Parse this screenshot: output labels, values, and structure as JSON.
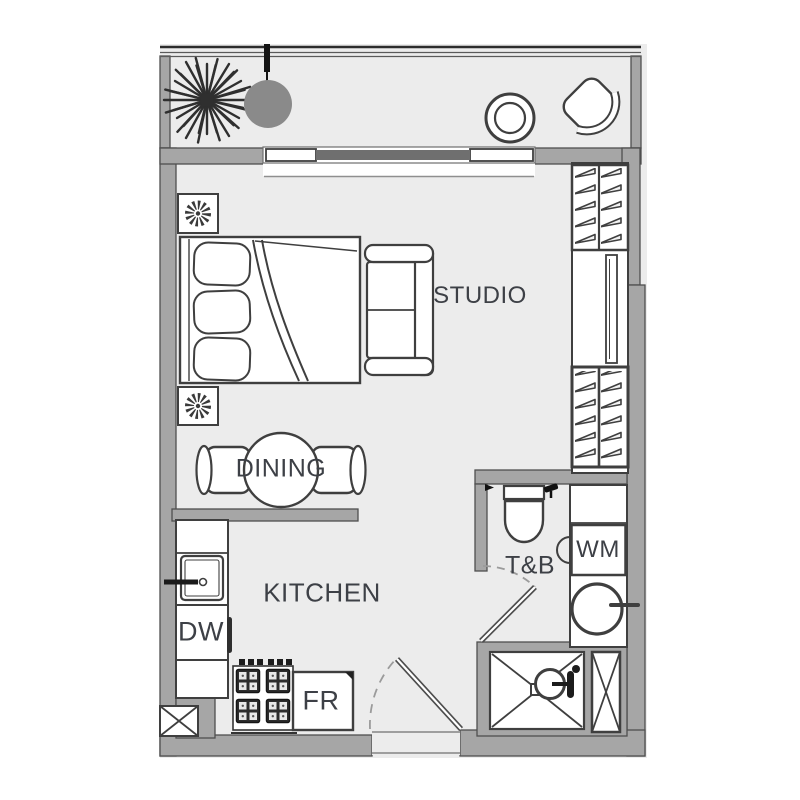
{
  "title": "Studio unit floor plan",
  "labels": {
    "studio": "STUDIO",
    "dining": "DINING",
    "kitchen": "KITCHEN",
    "bath": "T&B",
    "washing_machine": "WM",
    "dishwasher": "DW",
    "fridge": "FR"
  },
  "icons": [
    "plant-icon",
    "pendant-ball-icon",
    "round-table-icon",
    "armchair-icon",
    "ceiling-fan-icon",
    "bed-icon",
    "pillow-icon",
    "sofa-icon",
    "dining-table-icon",
    "dining-chair-icon",
    "hanger-rack-icon",
    "mirror-panel-icon",
    "toilet-icon",
    "tap-icon",
    "shower-head-icon",
    "wash-basin-icon",
    "kitchen-sink-icon",
    "stove-icon",
    "fridge-icon",
    "shower-tray-icon",
    "shaft-x-icon",
    "door-swing-icon",
    "window-slider-icon"
  ],
  "palette": {
    "wall": "#a6a6a6",
    "wall_edge": "#4f4f4f",
    "floor": "#ececec",
    "line": "#3f3f3f",
    "dark_fixture": "#2d2d2d",
    "window_slider": "#6f6f6f",
    "balcony_ball": "#8a8a8a",
    "label_text": "#3d4046",
    "white": "#ffffff"
  }
}
